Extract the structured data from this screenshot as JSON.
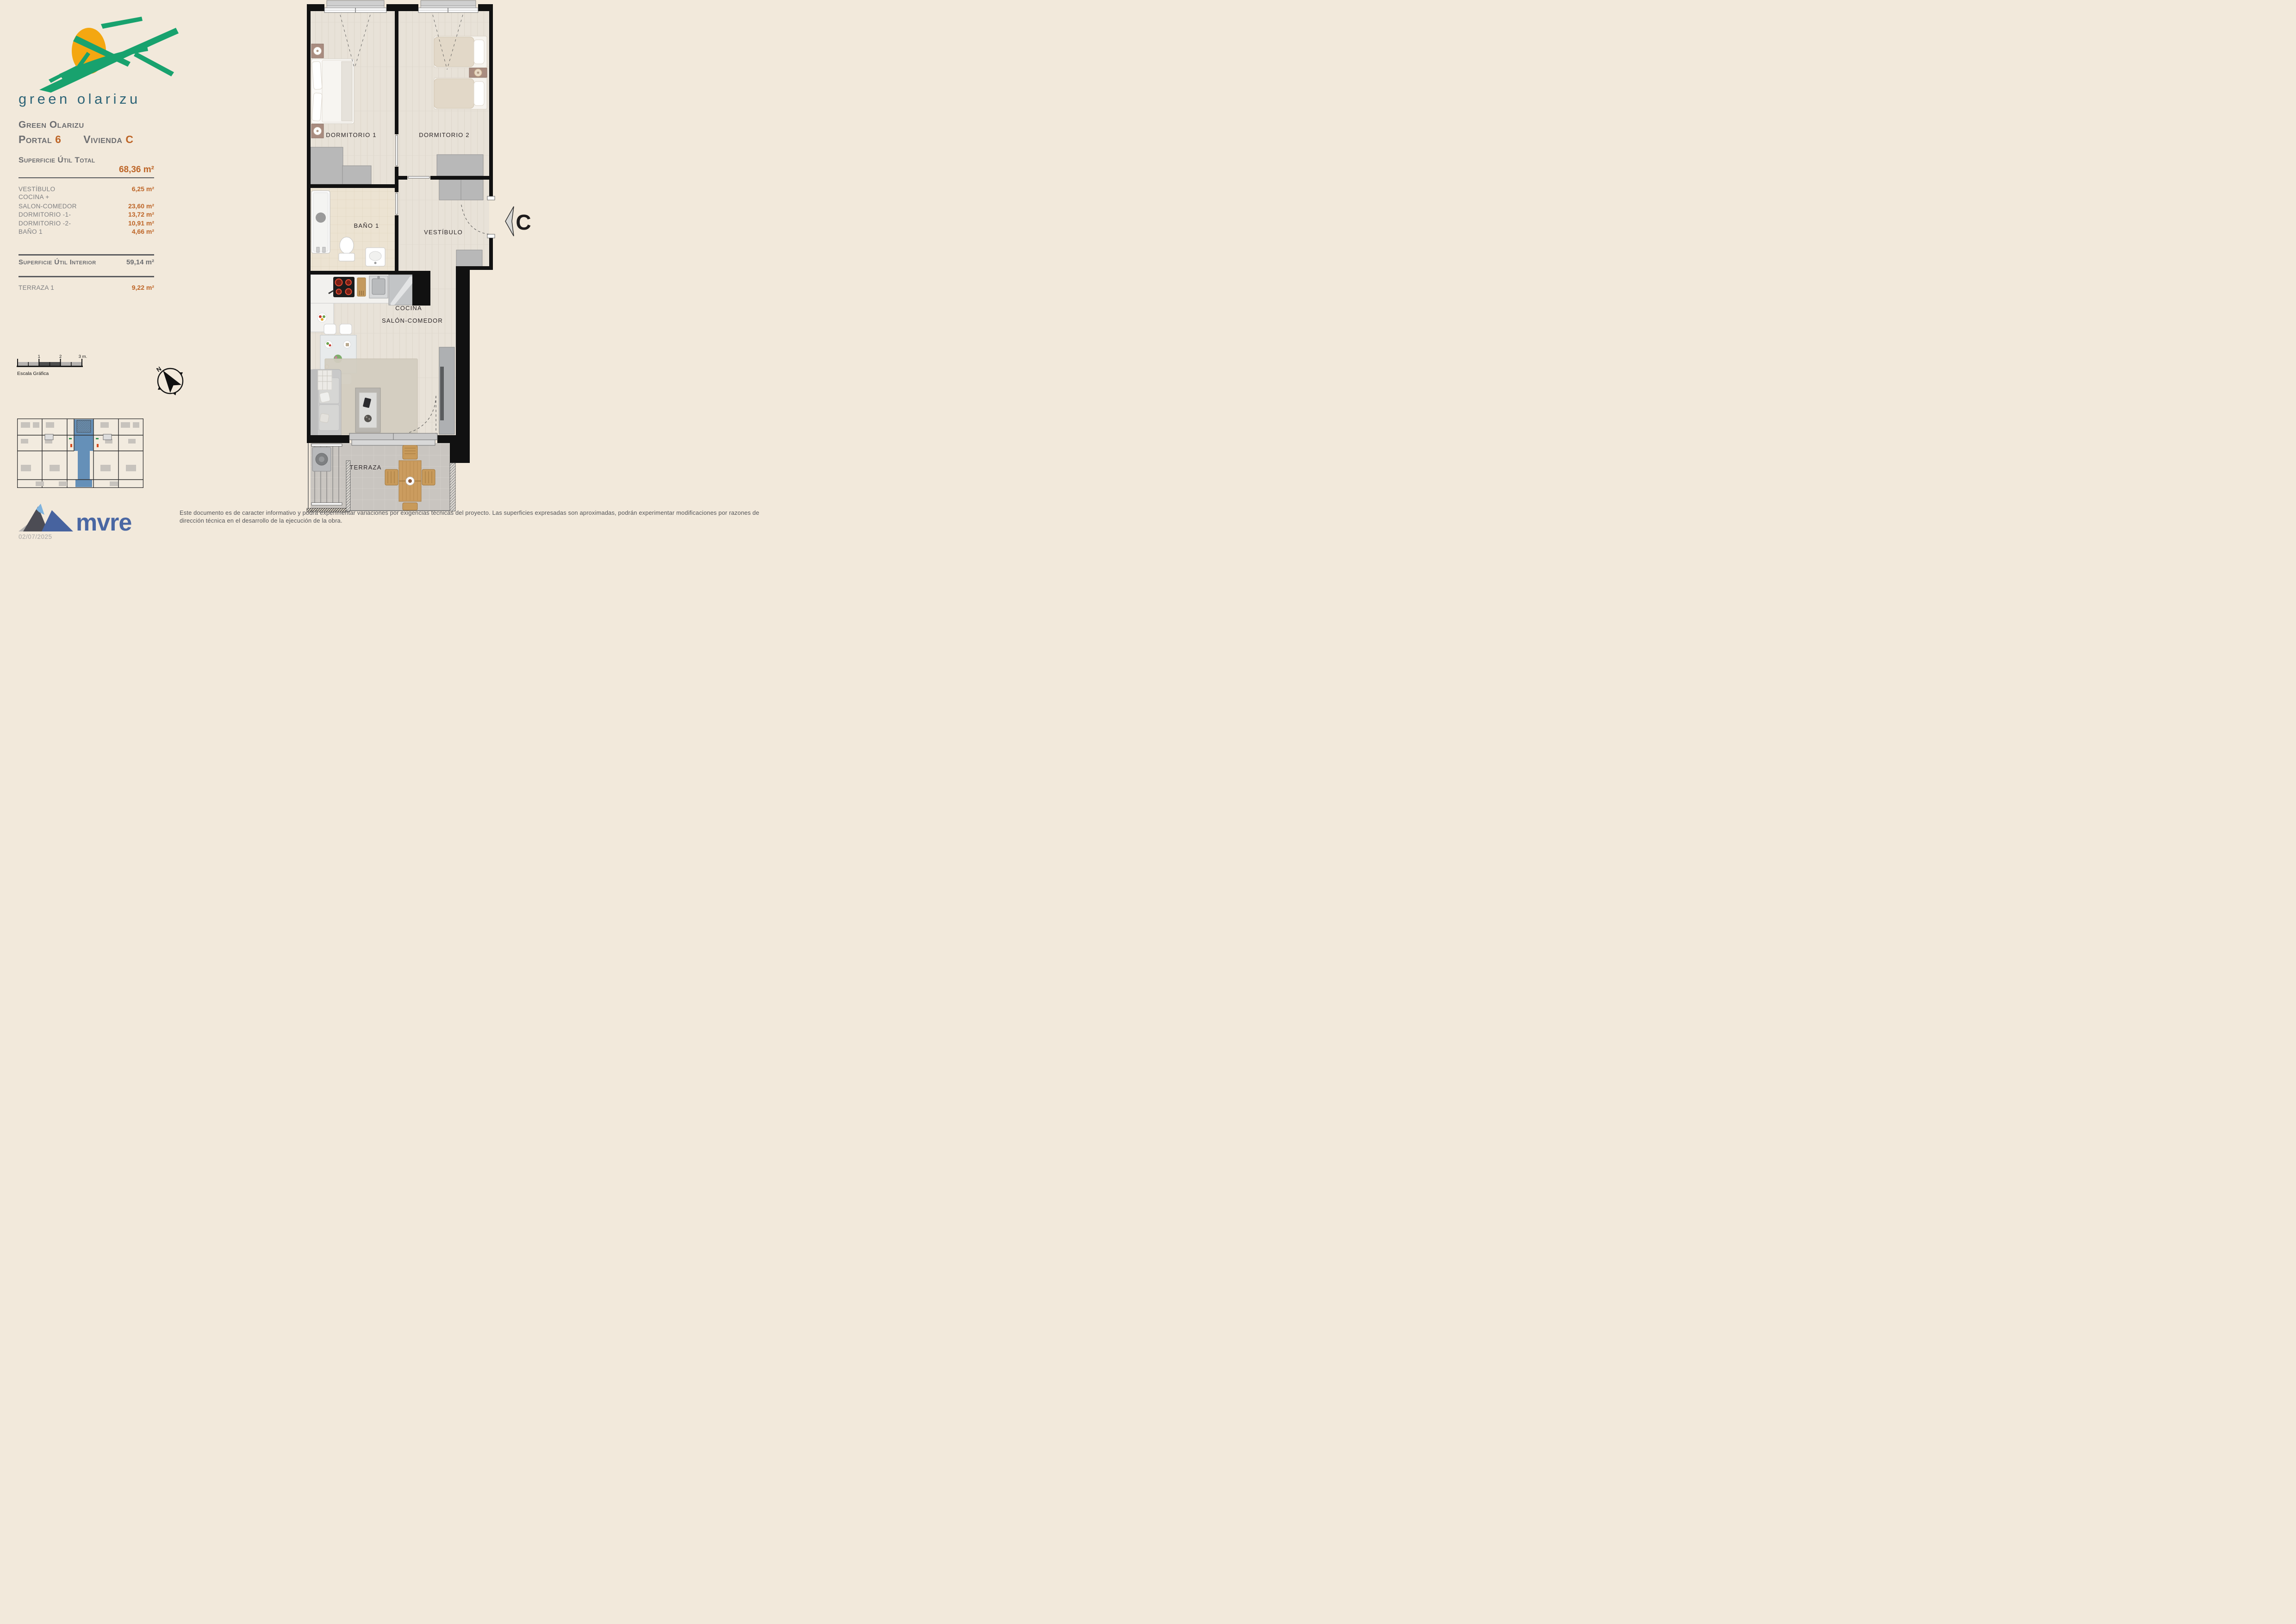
{
  "colors": {
    "background": "#f2e9db",
    "accent_orange": "#bd6426",
    "text_gray": "#6d6e71",
    "logo_green": "#18a26e",
    "logo_sun": "#f4a711",
    "brand_teal": "#2d6477",
    "mvre_blue": "#4a67a3",
    "keyplan_highlight": "#6590b8",
    "wall_black": "#111111"
  },
  "brand": {
    "logo_text": "green olarizu"
  },
  "info_panel": {
    "project": "Green Olarizu",
    "portal_label": "Portal",
    "portal_value": "6",
    "vivienda_label": "Vivienda",
    "vivienda_value": "C",
    "total_label": "Superficie Útil Total",
    "total_value": "68,36 m²",
    "rooms": [
      {
        "name": "VESTÍBULO",
        "area": "6,25 m²"
      },
      {
        "name": "COCINA +",
        "area": ""
      },
      {
        "name": "SALON-COMEDOR",
        "area": "23,60 m²"
      },
      {
        "name": "DORMITORIO -1-",
        "area": "13,72 m²"
      },
      {
        "name": "DORMITORIO -2-",
        "area": "10,91 m²"
      },
      {
        "name": "BAÑO 1",
        "area": "4,66 m²"
      }
    ],
    "interior_label": "Superficie Útil Interior",
    "interior_value": "59,14 m²",
    "terraza_label": "TERRAZA 1",
    "terraza_value": "9,22 m²"
  },
  "scale_bar": {
    "label": "Escala Gráfica",
    "ticks": [
      "1",
      "2",
      "3 m."
    ]
  },
  "compass": {
    "north_label": "N"
  },
  "plan": {
    "rooms": {
      "dormitorio1": "DORMITORIO 1",
      "dormitorio2": "DORMITORIO 2",
      "bano1": "BAÑO 1",
      "vestibulo": "VESTÍBULO",
      "cocina": "COCINA",
      "salon": "SALÓN-COMEDOR",
      "terraza": "TERRAZA"
    },
    "entrance_marker": "C"
  },
  "footer": {
    "logo_text": "mvre",
    "date": "02/07/2025",
    "disclaimer": "Este documento es de caracter informativo y podrá experimentar variaciones por exigencias técnicas del proyecto. Las superficies expresadas son aproximadas, podrán experimentar modificaciones por razones de dirección técnica en el desarrollo de la ejecución de la obra."
  }
}
